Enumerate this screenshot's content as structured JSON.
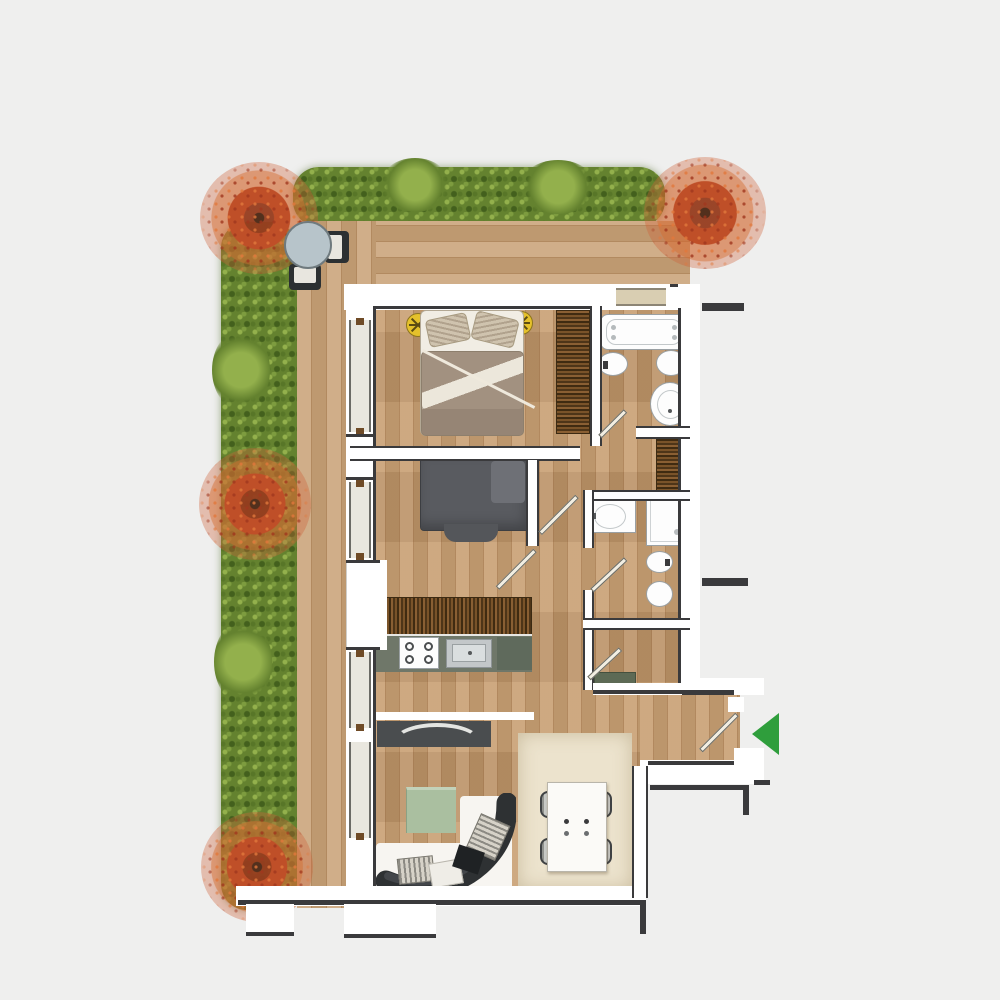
{
  "meta": {
    "title": "apartment-floor-plan-top-view",
    "canvas_px": {
      "width": 1000,
      "height": 1000
    },
    "visible_text": "none"
  },
  "palette": {
    "bg": "#efefee",
    "wallFill": "#ffffff",
    "wallLine": "#3a3a3c",
    "floor": "#c59a6c",
    "deck": "#c8a176",
    "hedge": "#64822f",
    "hedgeLight": "#93b04c",
    "hedgeDark": "#43601d",
    "treeRed": "#bf4f28",
    "treeCore": "#52301d",
    "fixtureFill": "#fdfdfd",
    "fixtureLine": "#9aa0a3",
    "counter": "#6f7769",
    "counterDark": "#5f6a5c",
    "steel": "#c3c7c9",
    "sofa": "#2e3133",
    "cushion": "#d6d2c8",
    "rugWhite": "#f7f5f1",
    "rugBeige": "#ece3cd",
    "accentGreen": "#2f9e3c",
    "lamp": "#e5c12b",
    "terraceTable": "#b7c4ca",
    "chairDark": "#2c3032",
    "wardrobe": "#6f4b27",
    "doorLeaf": "#f2eee2",
    "duvet": "#a29180",
    "sheet": "#f1ede4",
    "blanket": "#595b60",
    "sill": "#d9ceb2",
    "glass": "#e9e7df",
    "console": "#5d6a55",
    "tvUnit": "#4a4d4f",
    "greenTable": "#aabfa0"
  },
  "scene": {
    "type": "apartment-floor-plan",
    "view": "top-down",
    "rooms": [
      {
        "name": "terrace",
        "items": [
          "perimeter-hedge",
          "autumn-tree-top-left",
          "autumn-tree-top-right",
          "autumn-tree-mid-left",
          "autumn-tree-bottom-left",
          "bistro-table",
          "terrace-chair-right",
          "terrace-chair-bottom",
          "wood-decking"
        ]
      },
      {
        "name": "master-bedroom",
        "items": [
          "double-bed",
          "ceiling-lamp-left",
          "ceiling-lamp-right",
          "fringe-wardrobe"
        ]
      },
      {
        "name": "main-bathroom",
        "items": [
          "whirlpool-bathtub",
          "bidet",
          "toilet",
          "round-washbasin",
          "window",
          "door"
        ]
      },
      {
        "name": "second-bedroom",
        "items": [
          "single-bed",
          "fringe-wardrobe",
          "door"
        ]
      },
      {
        "name": "second-bathroom",
        "items": [
          "washbasin-counter",
          "shower-tray",
          "bidet",
          "toilet",
          "door"
        ]
      },
      {
        "name": "kitchen",
        "items": [
          "counter-run",
          "four-burner-cooktop",
          "steel-sink"
        ]
      },
      {
        "name": "living-dining",
        "items": [
          "curved-sectional-sofa",
          "white-rug",
          "tv-sideboard",
          "green-coffee-table",
          "dining-table",
          "dining-chairs-x4",
          "beige-shag-rug",
          "door"
        ]
      },
      {
        "name": "entry-hall",
        "items": [
          "entrance-door",
          "console-shelf",
          "hall-wardrobe"
        ]
      }
    ],
    "counts": {
      "bedrooms": 2,
      "bathrooms": 2,
      "dining_chairs": 4,
      "terrace_trees": 4,
      "ceiling_lamps": 2
    },
    "entrance_marker": {
      "shape": "triangle",
      "points": "left",
      "color": "#2f9e3c"
    }
  }
}
